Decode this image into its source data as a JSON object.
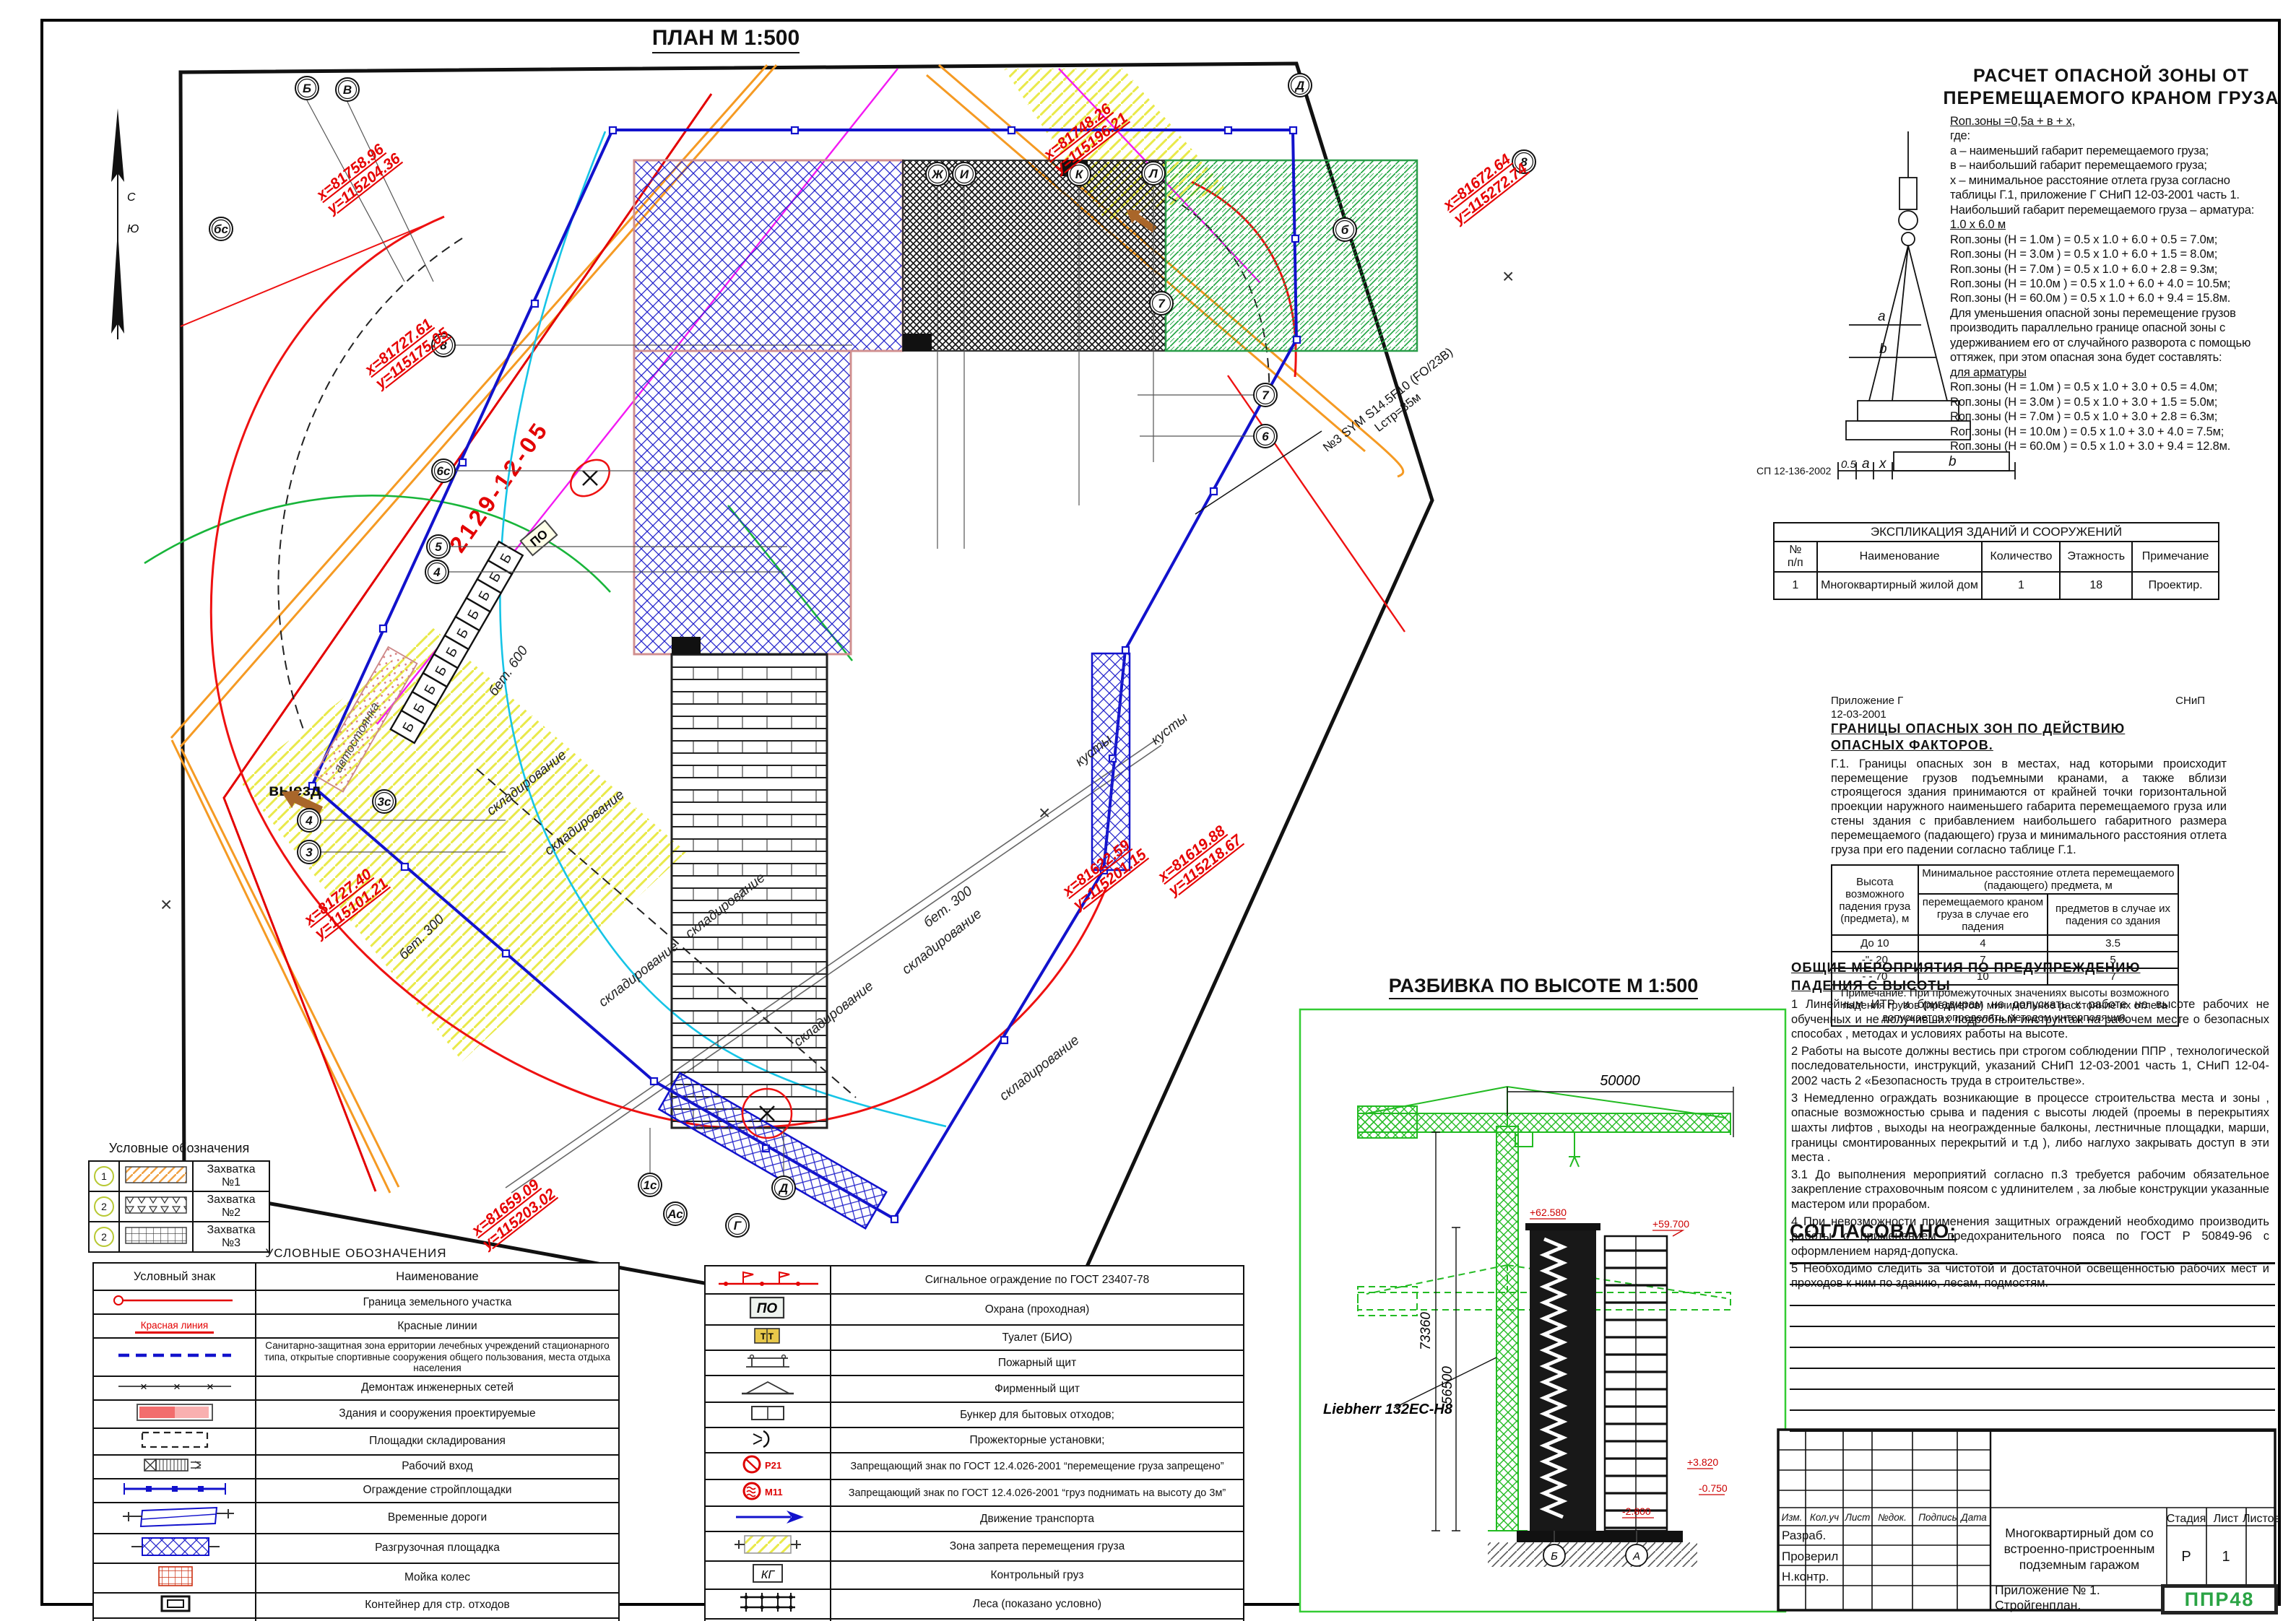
{
  "plan": {
    "title": "ПЛАН М 1:500",
    "north_n": "С",
    "north_s": "Ю",
    "cadastral": "2129-12-05",
    "coords": [
      {
        "x": "х=81758.96",
        "y": "у=115204.36"
      },
      {
        "x": "х=81748.26",
        "y": "у=115196.21"
      },
      {
        "x": "х=81672.64",
        "y": "у=115272.74"
      },
      {
        "x": "х=81727.61",
        "y": "у=115175.05"
      },
      {
        "x": "х=81727.40",
        "y": "у=115101.21"
      },
      {
        "x": "х=81659.09",
        "y": "у=115203.02"
      },
      {
        "x": "х=81622.59",
        "y": "у=115201.15"
      },
      {
        "x": "х=81619.88",
        "y": "у=115218.67"
      }
    ],
    "axes": [
      {
        "label": "Б"
      },
      {
        "label": "В"
      },
      {
        "label": "Ж"
      },
      {
        "label": "И"
      },
      {
        "label": "К"
      },
      {
        "label": "Л"
      },
      {
        "label": "Д"
      },
      {
        "label": "8"
      },
      {
        "label": "8"
      },
      {
        "label": "7"
      },
      {
        "label": "7"
      },
      {
        "label": "6"
      },
      {
        "label": "6с"
      },
      {
        "label": "5"
      },
      {
        "label": "4"
      },
      {
        "label": "3с"
      },
      {
        "label": "4"
      },
      {
        "label": "3"
      },
      {
        "label": "1с"
      },
      {
        "label": "Ас"
      },
      {
        "label": "Г"
      },
      {
        "label": "Д"
      },
      {
        "label": "бс"
      },
      {
        "label": "б"
      }
    ],
    "labels": {
      "exit": "выезд",
      "parking": "автостоянка",
      "storage": "складирование",
      "bet600": "бет. 600",
      "bet300": "бет. 300",
      "bushes": "кусты",
      "cabin": "Б",
      "guard": "ПО",
      "crane_note1": "№3 SYM  S14.5F10  (FO/23В)",
      "crane_note2": "Lстр=35м"
    }
  },
  "calc": {
    "title_line1": "РАСЧЕТ ОПАСНОЙ ЗОНЫ ОТ",
    "title_line2": "ПЕРЕМЕЩАЕМОГО КРАНОМ ГРУЗА",
    "formula": "Rоп.зоны =0,5а + в + х,",
    "where": "где:",
    "def_a": "а – наименьший габарит перемещаемого груза;",
    "def_b": "в – наибольший габарит перемещаемого груза;",
    "def_x": "х – минимальное расстояние отлета груза согласно таблицы Г.1, приложение Г СНиП 12-03-2001 часть 1.",
    "max1": "Наибольший  габарит перемещаемого груза – арматура:",
    "max2": "1.0 х 6.0 м",
    "rows1": [
      "Rоп.зоны (Н = 1.0м ) = 0.5 х 1.0 + 6.0 + 0.5 = 7.0м;",
      "Rоп.зоны (Н = 3.0м ) = 0.5 х 1.0 + 6.0 + 1.5 = 8.0м;",
      "Rоп.зоны (Н = 7.0м ) = 0.5 х 1.0 + 6.0 + 2.8 = 9.3м;",
      "Rоп.зоны (Н = 10.0м ) = 0.5 х 1.0 + 6.0 + 4.0 = 10.5м;",
      "Rоп.зоны (Н = 60.0м ) = 0.5 х 1.0 + 6.0 + 9.4 = 15.8м."
    ],
    "para": "Для уменьшения опасной зоны перемещение грузов производить параллельно границе опасной зоны с удерживанием его от случайного разворота с помощью оттяжек, при этом опасная зона будет составлять:",
    "for_arm": "для арматуры",
    "rows2": [
      "Rоп.зоны (Н = 1.0м ) = 0.5 х 1.0 + 3.0 + 0.5 = 4.0м;",
      "Rоп.зоны (Н = 3.0м ) = 0.5 х 1.0 + 3.0 + 1.5 = 5.0м;",
      "Rоп.зоны (Н = 7.0м ) = 0.5 х 1.0 + 3.0 + 2.8 = 6.3м;",
      "Rоп.зоны (Н = 10.0м ) = 0.5 х 1.0 + 3.0 + 4.0 = 7.5м;",
      "Rоп.зоны (Н = 60.0м ) = 0.5 х 1.0 + 3.0 + 9.4 = 12.8м."
    ],
    "diagram": {
      "code": "СП 12-136-2002",
      "d05": "0.5",
      "da": "a",
      "dx": "x",
      "db": "b",
      "dim_a": "a",
      "dim_b": "b"
    }
  },
  "expl": {
    "title": "ЭКСПЛИКАЦИЯ ЗДАНИЙ И СООРУЖЕНИЙ",
    "headers": [
      "№\nп/п",
      "Наименование",
      "Количество",
      "Этажность",
      "Примечание"
    ],
    "row": [
      "1",
      "Многоквартирный жилой дом",
      "1",
      "18",
      "Проектир."
    ]
  },
  "hazard": {
    "app": "Приложение Г",
    "snip": "СНиП",
    "code": "12-03-2001",
    "title1": "ГРАНИЦЫ  ОПАСНЫХ  ЗОН  ПО ДЕЙСТВИЮ",
    "title2": "ОПАСНЫХ  ФАКТОРОВ.",
    "para": "Г.1.  Границы опасных зон в местах, над которыми происходит перемещение грузов подъемными кранами, а также вблизи строящегося здания принимаются от крайней точки горизонтальной проекции наружного наименьшего габарита перемещаемого груза или стены здания с прибавлением наибольшего габаритного размера перемещаемого (падающего) груза и минимального расстояния отлета груза при его падении согласно  таблице Г.1.",
    "table": {
      "col1": "Высота возможного падения груза (предмета), м",
      "span": "Минимальное расстояние отлета перемещаемого (падающего) предмета, м",
      "sub1": "перемещаемого краном груза в случае его падения",
      "sub2": "предметов в случае их падения со здания",
      "rows": [
        [
          "До 10",
          "4",
          "3.5"
        ],
        [
          "-\"- 20",
          "7",
          "5"
        ],
        [
          "- - 70",
          "10",
          "7"
        ]
      ],
      "note": "Примечание. При промежуточных значениях высоты возможного падения грузов (предметов) минимальное расстояние их отлета допускается определять методом интерполяции."
    }
  },
  "measures": {
    "title1": "ОБЩИЕ  МЕРОПРИЯТИЯ  ПО ПРЕДУПРЕЖДЕНИЮ",
    "title2": "ПАДЕНИЯ  С ВЫСОТЫ",
    "items": [
      "1  Линейным ИТР и бригадирам не допускать к работе на высоте рабочих не обученных  и не получивших подробный инструктаж на рабочем месте о безопасных способах , методах  и условиях работы на высоте.",
      "2  Работы на высоте должны вестись при строгом соблюдении ППР , технологической последовательности, инструкций, указаний СНиП 12-03-2001 часть 1, СНиП 12-04-2002 часть 2 «Безопасность труда в строительстве».",
      "3  Немедленно ограждать возникающие в процессе строительства места и зоны , опасные возможностью срыва и падения с высоты людей (проемы в перекрытиях шахты лифтов , выходы на неогражденные балконы, лестничные площадки, марши, границы смонтированных перекрытий и т.д ), либо наглухо закрывать доступ в эти места .",
      "3.1 До выполнения мероприятий согласно п.3 требуется рабочим обязательное закрепление страховочным поясом с удлинителем , за любые конструкции указанные мастером  или прорабом.",
      "4  При невозможности применения защитных ограждений необходимо производить работы   с применением предохранительного пояса по ГОСТ Р  50849-96 с оформлением наряд-допуска.",
      "5  Необходимо следить за чистотой и достаточной освещенностью рабочих мест  и проходов к ним по зданию, лесам, подмостям."
    ]
  },
  "approved": {
    "title": "СОГЛАСОВАНО:"
  },
  "elevation": {
    "title": "РАЗБИВКА ПО ВЫСОТЕ М 1:500",
    "dim_jib": "50000",
    "dim_h1": "73360",
    "dim_h2": "56500",
    "crane": "Liebherr 132EC-H8",
    "levels": {
      "roof": "+62.580",
      "roof2": "+59.700",
      "l1": "+3.820",
      "l2": "-0.750",
      "l3": "-2.800"
    },
    "axis_b": "Б",
    "axis_a": "А"
  },
  "legend_small": {
    "title": "Условные обозначения",
    "rows": [
      {
        "num": "1",
        "label": "Захватка №1"
      },
      {
        "num": "2",
        "label": "Захватка №2"
      },
      {
        "num": "2",
        "label": "Захватка №3"
      }
    ]
  },
  "legend_left": {
    "title": "УСЛОВНЫЕ ОБОЗНАЧЕНИЯ",
    "col1": "Условный знак",
    "col2": "Наименование",
    "red_line_label": "Красная линия",
    "rows": [
      "Граница земельного участка",
      "Красные линии",
      "Санитарно-защитная зона ерритории лечебных учреждений стационарного типа, открытые спортивные сооружения общего пользования, места отдыха населения",
      "Демонтаж инженерных сетей",
      "Здания и сооружения проектируемые",
      "Площадки складирования",
      "Рабочий вход",
      "Ограждение стройплощадки",
      "Временные дороги",
      "Разгрузочная площадка",
      "Мойка колес",
      "Контейнер для стр. отходов",
      "Граница опасной зоны от падения со здания",
      "Граница опасной зоны от перемещаемого груза"
    ]
  },
  "legend_right": {
    "sym": {
      "po": "ПО",
      "tt": "Т Т",
      "p21": "Р21",
      "m11": "М11",
      "kg": "КГ"
    },
    "rows": [
      "Сигнальное ограждение по ГОСТ 23407-78",
      "Охрана (проходная)",
      "Туалет (БИО)",
      "Пожарный щит",
      "Фирменный щит",
      "Бункер для бытовых отходов;",
      "Прожекторные установки;",
      "Запрещающий знак  по ГОСТ 12.4.026-2001   “перемещение груза запрещено”",
      "Запрещающий знак  по ГОСТ 12.4.026-2001   “груз поднимать на высоту до 3м”",
      "Движение транспорта",
      "Зона запрета перемещения груза",
      "Контрольный груз",
      "Леса (показано условно)",
      "Бункер с бетоном"
    ]
  },
  "stamp": {
    "cols": [
      "Изм.",
      "Кол.уч",
      "Лист",
      "№док.",
      "Подпись",
      "Дата"
    ],
    "rows": [
      "Разраб.",
      "Проверил",
      "Н.контр."
    ],
    "project": "Многоквартирный дом со встроенно-пристроенным подземным гаражом",
    "stage_h": "Стадия",
    "sheet_h": "Лист",
    "sheets_h": "Листов",
    "stage": "Р",
    "sheet": "1",
    "appendix": "Приложение № 1. Стройгенплан.",
    "logo": "ППР48"
  }
}
